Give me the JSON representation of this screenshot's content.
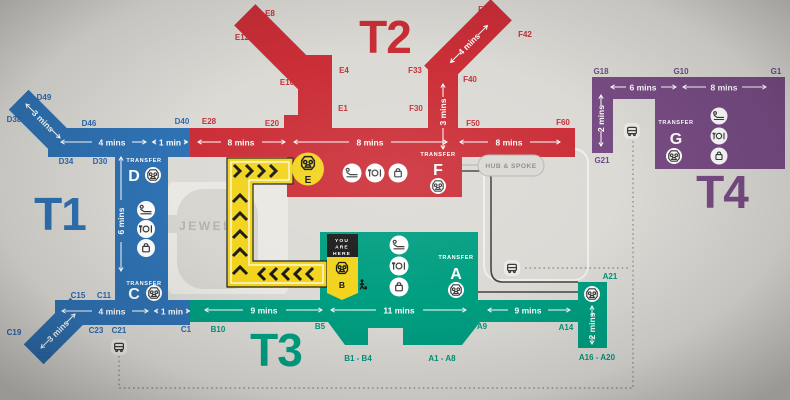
{
  "colors": {
    "t1": "#2f72b3",
    "t2": "#cb2e37",
    "t3": "#009e81",
    "t4": "#784c84",
    "path": "#f2d41d",
    "bg": "#dcdad5",
    "t1_text": "#2b6ab1",
    "t2_text": "#c3303a",
    "t3_text": "#00947c",
    "t4_text": "#6d4a87"
  },
  "terminals": {
    "t1": {
      "label": "T1"
    },
    "t2": {
      "label": "T2"
    },
    "t3": {
      "label": "T3"
    },
    "t4": {
      "label": "T4"
    }
  },
  "gates": {
    "d49": "D49",
    "d38": "D38",
    "d46": "D46",
    "d40": "D40",
    "d34": "D34",
    "d30": "D30",
    "e28": "E28",
    "e20": "E20",
    "e8": "E8",
    "e12": "E12",
    "e10": "E10",
    "e4": "E4",
    "e1": "E1",
    "f37": "F37",
    "f42": "F42",
    "f33": "F33",
    "f40": "F40",
    "f30": "F30",
    "f50": "F50",
    "f60": "F60",
    "g18": "G18",
    "g10": "G10",
    "g1": "G1",
    "g21": "G21",
    "c15": "C15",
    "c11": "C11",
    "c23": "C23",
    "c21": "C21",
    "c19": "C19",
    "c26": "C26",
    "c1": "C1",
    "b10": "B10",
    "b5": "B5",
    "b1_b4": "B1 - B4",
    "a1_a8": "A1 - A8",
    "a9": "A9",
    "a14": "A14",
    "a16_a20": "A16 - A20",
    "a21": "A21"
  },
  "times": {
    "t1_top_arm": "3 mins",
    "t1_top_1": "4 mins",
    "t1_top_2": "1 min",
    "t1_col": "6 mins",
    "t1_bot_1": "4 mins",
    "t1_bot_2": "1 min",
    "t1_bot_arm": "3 mins",
    "t2_1": "8 mins",
    "t2_2": "8 mins",
    "t2_3": "8 mins",
    "t2_arm": "4 mins",
    "t2_col": "3 mins",
    "t3_1": "9 mins",
    "t3_2": "11 mins",
    "t3_3": "9 mins",
    "t3_arm": "2 mins",
    "t4_1": "6 mins",
    "t4_2": "8 mins",
    "t4_arm": "2 mins"
  },
  "transfers": {
    "d": {
      "title": "TRANSFER",
      "letter": "D"
    },
    "c": {
      "title": "TRANSFER",
      "letter": "C"
    },
    "f": {
      "title": "TRANSFER",
      "letter": "F"
    },
    "a": {
      "title": "TRANSFER",
      "letter": "A"
    },
    "g": {
      "title": "TRANSFER",
      "letter": "G"
    }
  },
  "stations": {
    "e": "E",
    "b": "B"
  },
  "you_are_here": {
    "l1": "YOU",
    "l2": "ARE",
    "l3": "HERE"
  },
  "landmarks": {
    "jewel": "JEWEL",
    "hub_spoke": "HUB & SPOKE"
  }
}
